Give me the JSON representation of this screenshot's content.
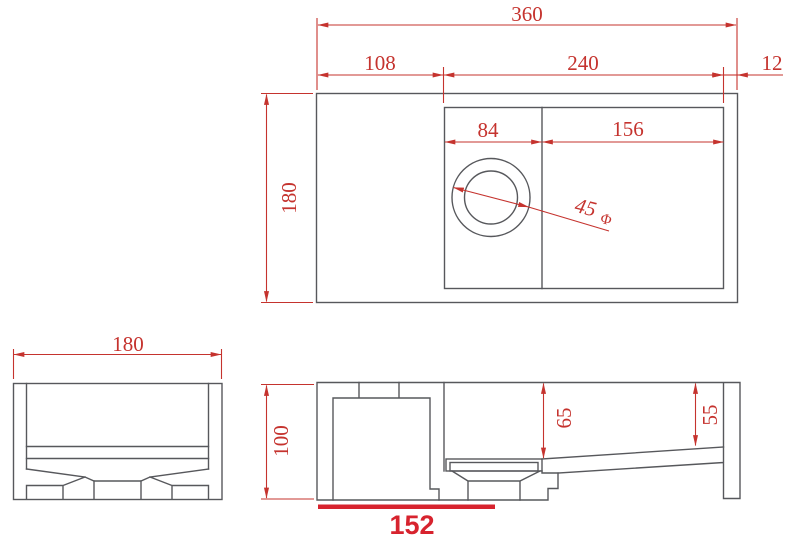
{
  "title": "Sink technical drawing with dimensions",
  "colors": {
    "background": "#ffffff",
    "line": "#57585c",
    "dimension": "#c5332e",
    "highlight": "#d7232e"
  },
  "views": {
    "top": {
      "name": "top-view",
      "dims": {
        "overall_width": "360",
        "left_segment": "108",
        "middle_segment": "240",
        "right_segment": "12",
        "depth": "180",
        "bowl_width": "84",
        "drainboard_width": "156",
        "drain_diameter": "45",
        "diameter_symbol": "Φ"
      }
    },
    "side": {
      "name": "side-view",
      "dims": {
        "width": "180"
      }
    },
    "front": {
      "name": "front-view",
      "dims": {
        "height": "100",
        "bowl_depth": "65",
        "right_end_depth": "55",
        "highlighted_length": "152"
      }
    }
  }
}
